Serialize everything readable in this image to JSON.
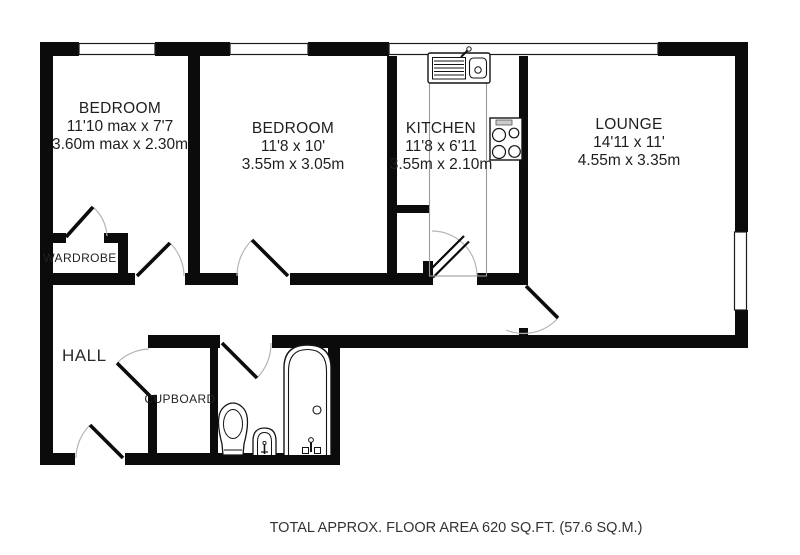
{
  "plan": {
    "rooms": [
      {
        "name": "BEDROOM",
        "size_ft": "11'10 max x 7'7",
        "size_m": "3.60m max x 2.30m"
      },
      {
        "name": "BEDROOM",
        "size_ft": "11'8 x 10'",
        "size_m": "3.55m x 3.05m"
      },
      {
        "name": "KITCHEN",
        "size_ft": "11'8 x 6'11",
        "size_m": "3.55m x 2.10m"
      },
      {
        "name": "LOUNGE",
        "size_ft": "14'11 x 11'",
        "size_m": "4.55m x 3.35m"
      }
    ],
    "areas": {
      "hall": "HALL",
      "wardrobe": "WARDROBE",
      "cupboard": "CUPBOARD"
    },
    "fixtures": [
      "kitchen-sink",
      "hob",
      "bath",
      "toilet",
      "basin"
    ]
  },
  "footer": {
    "total_area": "TOTAL APPROX. FLOOR AREA 620 SQ.FT. (57.6 SQ.M.)"
  },
  "colors": {
    "wall": "#0b0b0b",
    "text": "#1e1e1e",
    "door_arc": "#b5b5b5",
    "counter_outline": "#9a9a9a"
  }
}
